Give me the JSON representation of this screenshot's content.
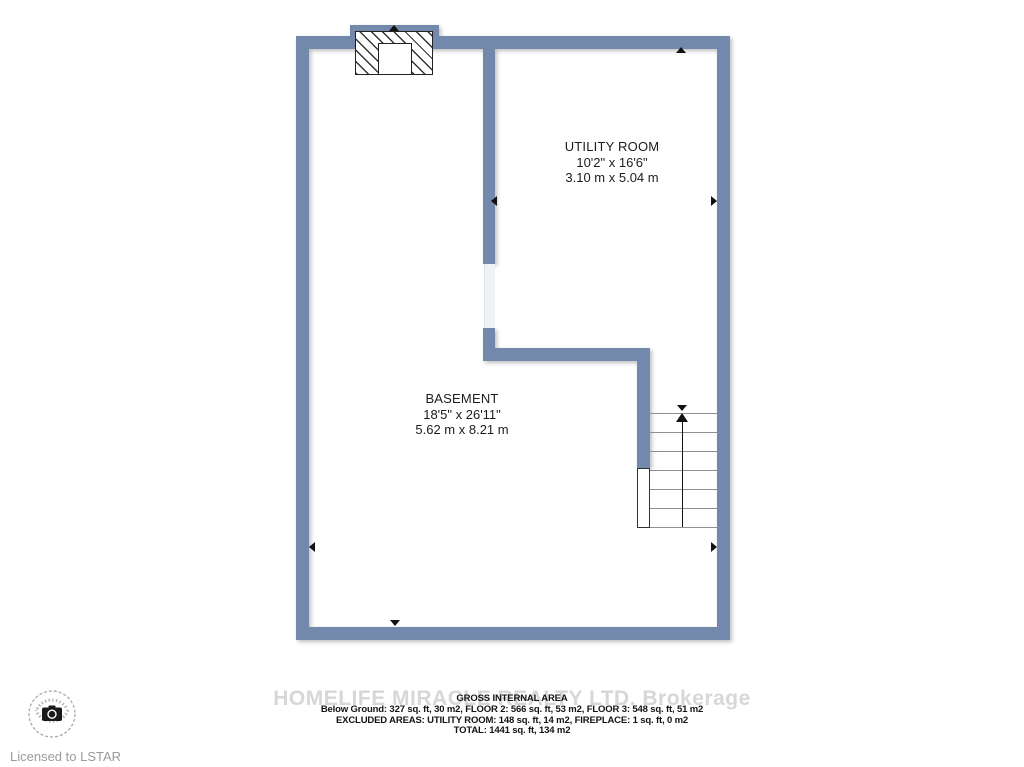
{
  "page": {
    "background": "#ffffff"
  },
  "colors": {
    "wall": "#7289ab",
    "tread_line": "#8f8f8f",
    "arrow": "#111111",
    "watermark": "#d7d7d7",
    "label_text": "#1c1c1c",
    "muted_text": "#9b9b9b"
  },
  "floorplan": {
    "rooms": [
      {
        "id": "utility-room",
        "name": "UTILITY ROOM",
        "imperial": "10'2\" x 16'6\"",
        "metric": "3.10 m x 5.04 m"
      },
      {
        "id": "basement",
        "name": "BASEMENT",
        "imperial": "18'5\" x 26'11\"",
        "metric": "5.62 m x 8.21 m"
      }
    ],
    "features": [
      "fireplace",
      "stairs-up",
      "door-openings"
    ]
  },
  "area_summary": {
    "title": "GROSS INTERNAL AREA",
    "lines": [
      "Below Ground: 327 sq. ft, 30 m2, FLOOR 2: 566 sq. ft, 53 m2, FLOOR 3: 548 sq. ft, 51 m2",
      "EXCLUDED AREAS: UTILITY ROOM: 148 sq. ft, 14 m2, FIREPLACE: 1 sq. ft, 0 m2",
      "TOTAL: 1441 sq. ft, 134 m2"
    ]
  },
  "watermark": "HOMELIFE MIRACLE REALTY LTD. Brokerage",
  "footer": {
    "license_text": "Licensed to LSTAR"
  }
}
